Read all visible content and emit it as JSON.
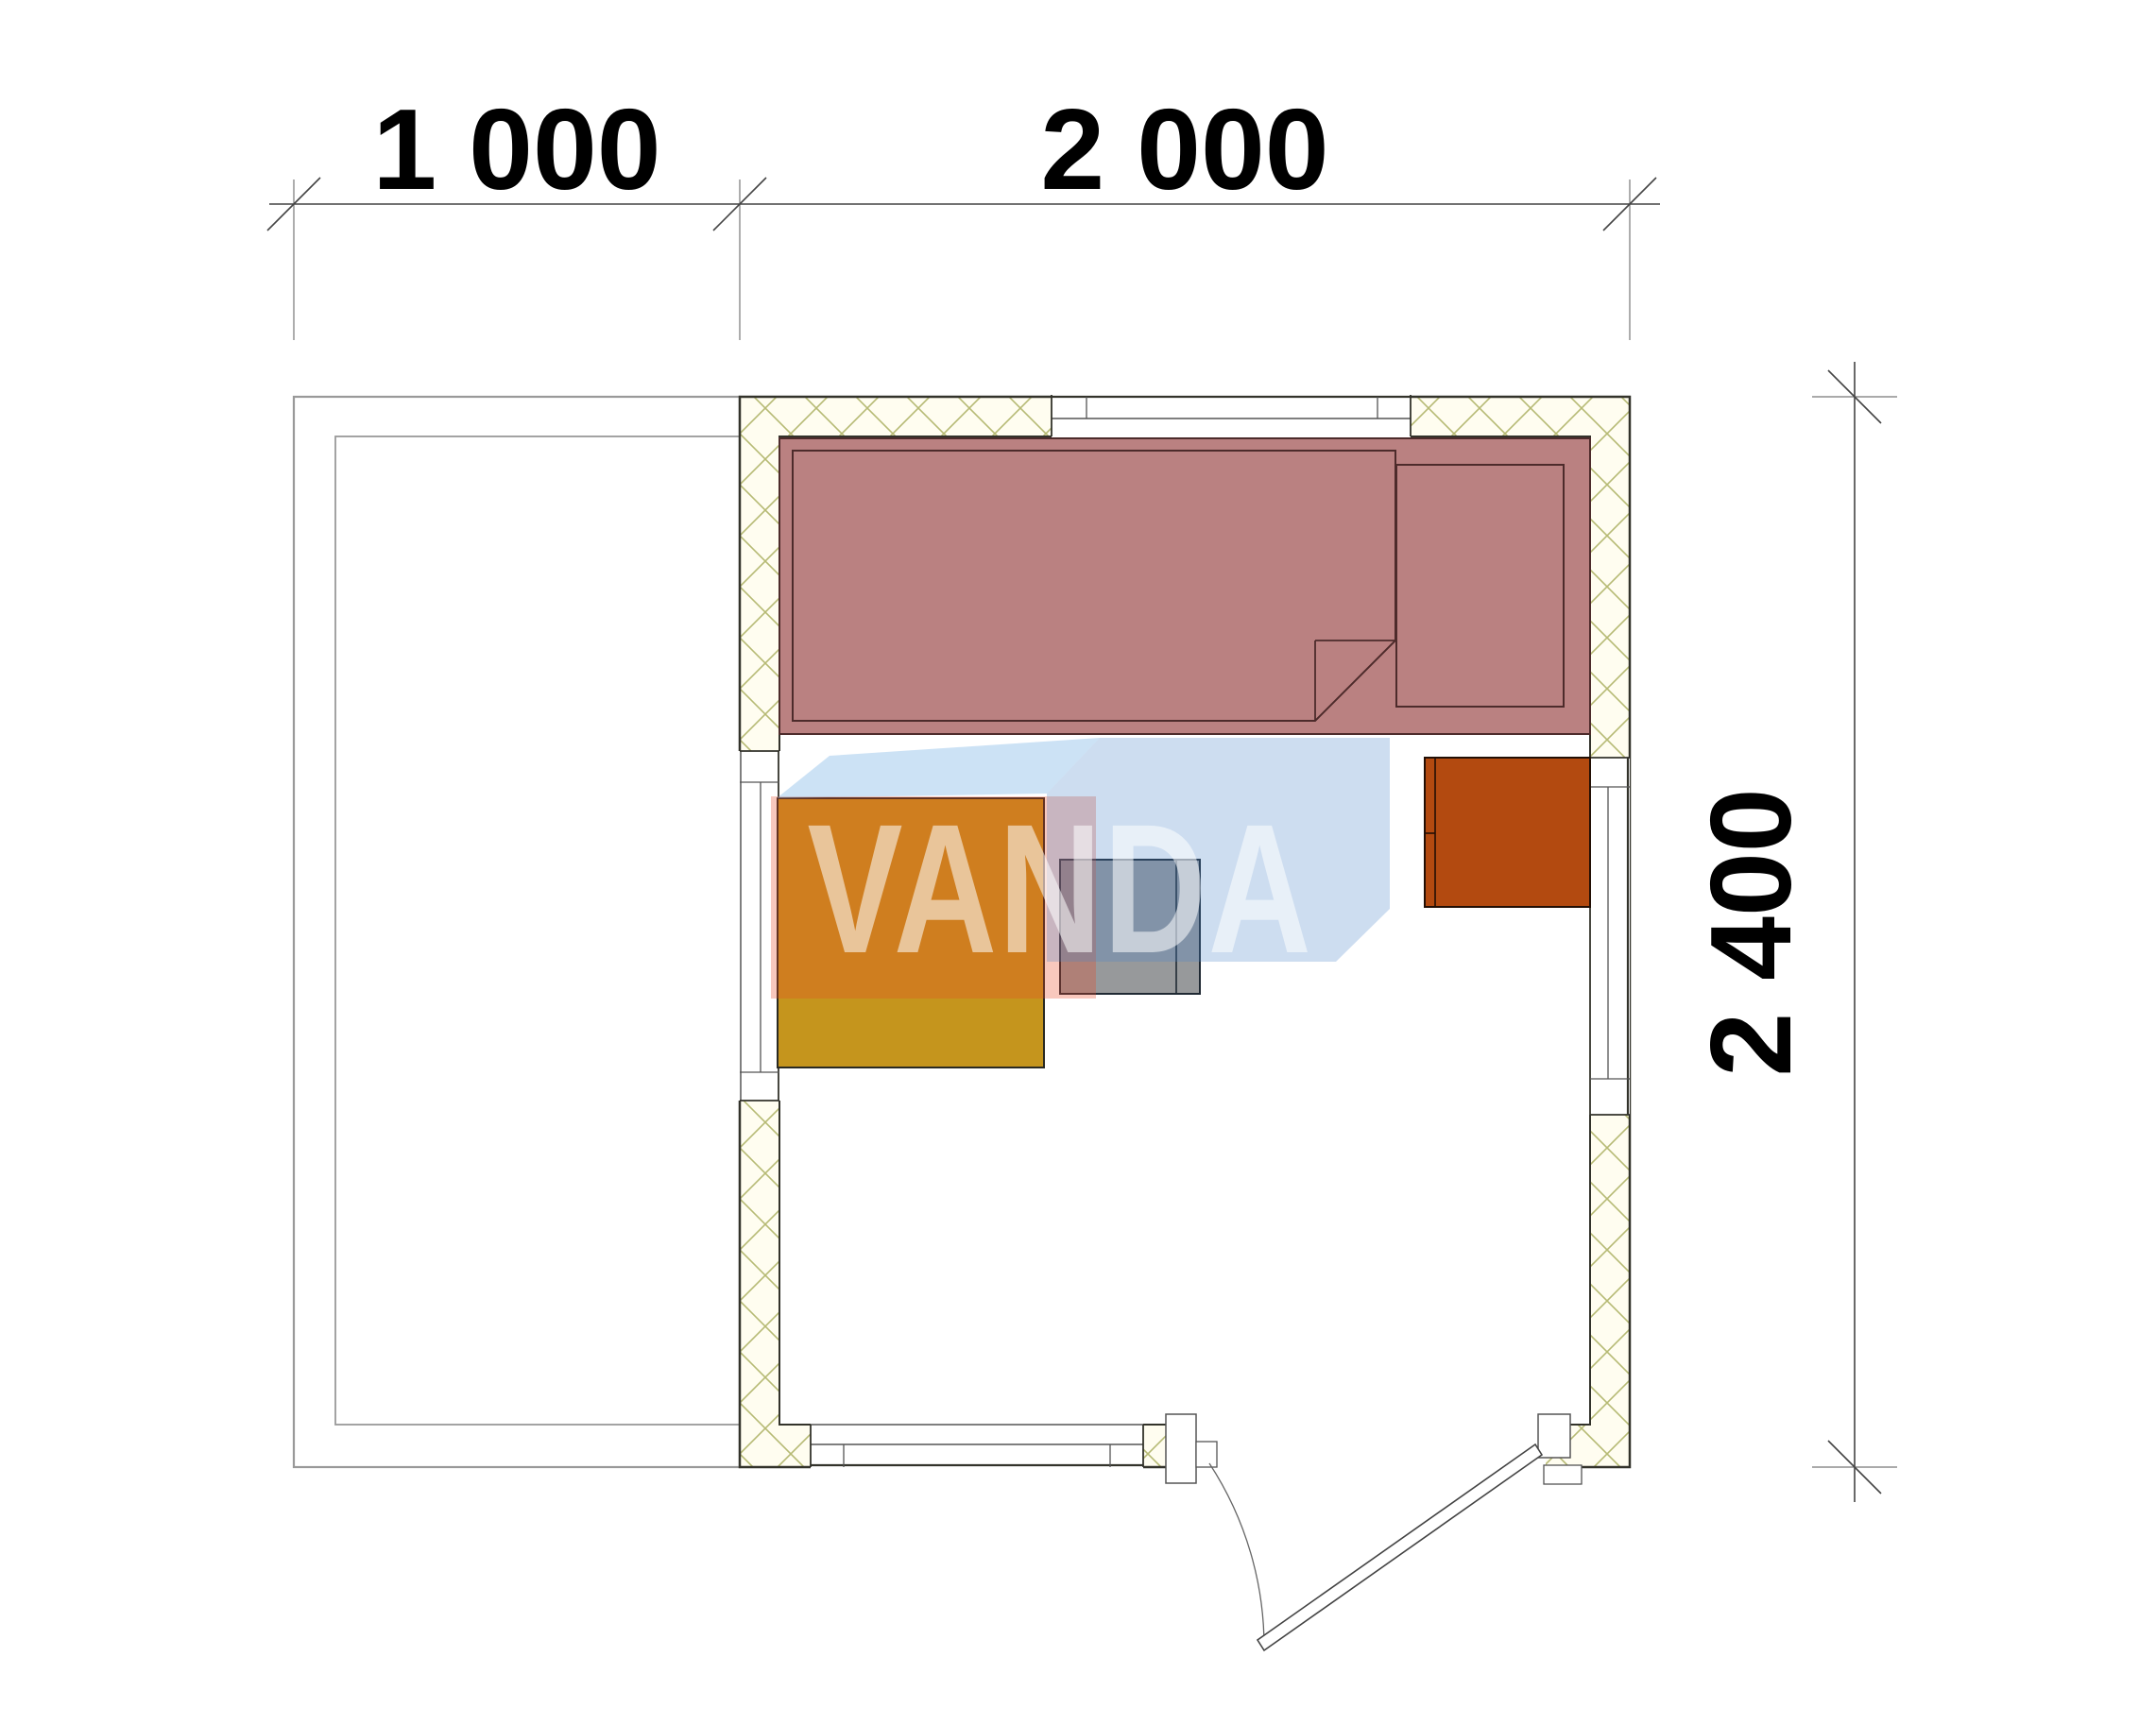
{
  "dimensions": {
    "terrace_width": "1 000",
    "building_width": "2 000",
    "building_depth": "2 400"
  },
  "watermark": {
    "text": "VANDA"
  },
  "colors": {
    "bed": "#ba8181",
    "bed_outline": "#4d2b2b",
    "table": "#c5951d",
    "stool": "#97999b",
    "stove": "#b34a10",
    "hatch_line": "#b6ba74",
    "wall_fill": "#fffdf0",
    "wall_line": "#33332b",
    "terrace_line": "#999999",
    "watermark_salmon": "#e84824",
    "watermark_blue": "#4a86c8",
    "watermark_blue_light": "#78b4e6",
    "dim_text": "#000000"
  }
}
